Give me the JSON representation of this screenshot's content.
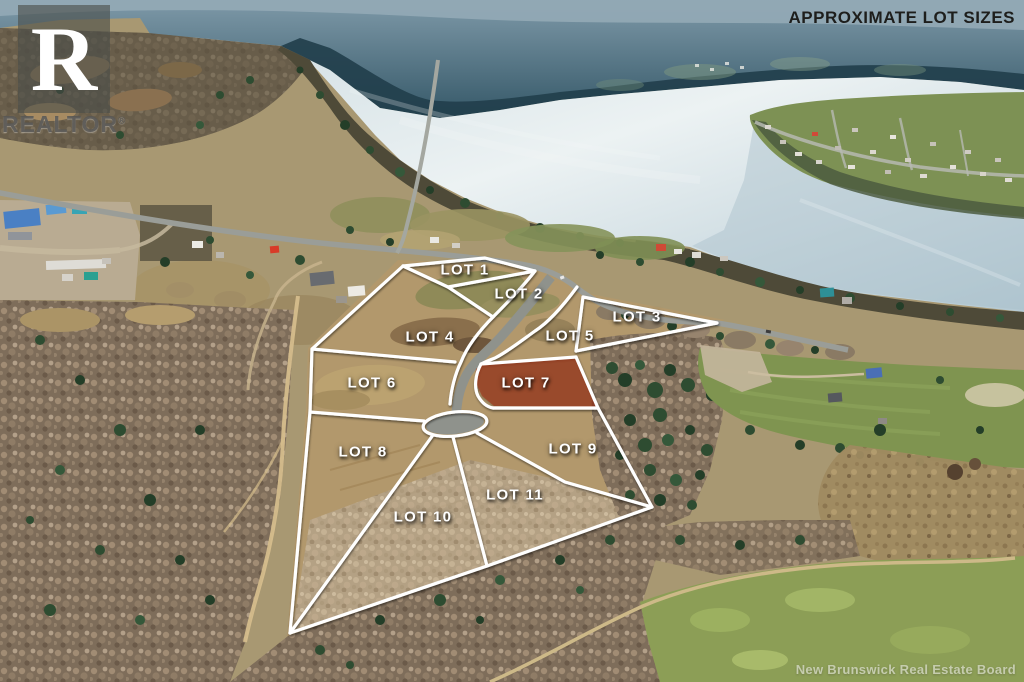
{
  "header": {
    "title": "APPROXIMATE LOT SIZES"
  },
  "branding": {
    "logo_letter": "R",
    "logo_text": "REALTOR",
    "registered_mark": "®"
  },
  "watermark": {
    "text": "New Brunswick Real Estate Board"
  },
  "lots": [
    {
      "id": 1,
      "label": "LOT 1",
      "x": 465,
      "y": 270,
      "highlighted": false
    },
    {
      "id": 2,
      "label": "LOT 2",
      "x": 519,
      "y": 294,
      "highlighted": false
    },
    {
      "id": 3,
      "label": "LOT 3",
      "x": 637,
      "y": 317,
      "highlighted": false
    },
    {
      "id": 4,
      "label": "LOT 4",
      "x": 430,
      "y": 337,
      "highlighted": false
    },
    {
      "id": 5,
      "label": "LOT 5",
      "x": 570,
      "y": 336,
      "highlighted": false
    },
    {
      "id": 6,
      "label": "LOT 6",
      "x": 372,
      "y": 383,
      "highlighted": false
    },
    {
      "id": 7,
      "label": "LOT 7",
      "x": 526,
      "y": 383,
      "highlighted": true
    },
    {
      "id": 8,
      "label": "LOT 8",
      "x": 363,
      "y": 452,
      "highlighted": false
    },
    {
      "id": 9,
      "label": "LOT 9",
      "x": 573,
      "y": 449,
      "highlighted": false
    },
    {
      "id": 10,
      "label": "LOT 10",
      "x": 423,
      "y": 517,
      "highlighted": false
    },
    {
      "id": 11,
      "label": "LOT 11",
      "x": 515,
      "y": 495,
      "highlighted": false
    }
  ],
  "palette": {
    "lot_line": "#ffffff",
    "lot_highlight": "#9b2c12",
    "label_text": "#ffffff",
    "title_text": "#1e1e1c",
    "watermark_text": "#ebebe8",
    "logo_overlay": "#4b4d49"
  }
}
